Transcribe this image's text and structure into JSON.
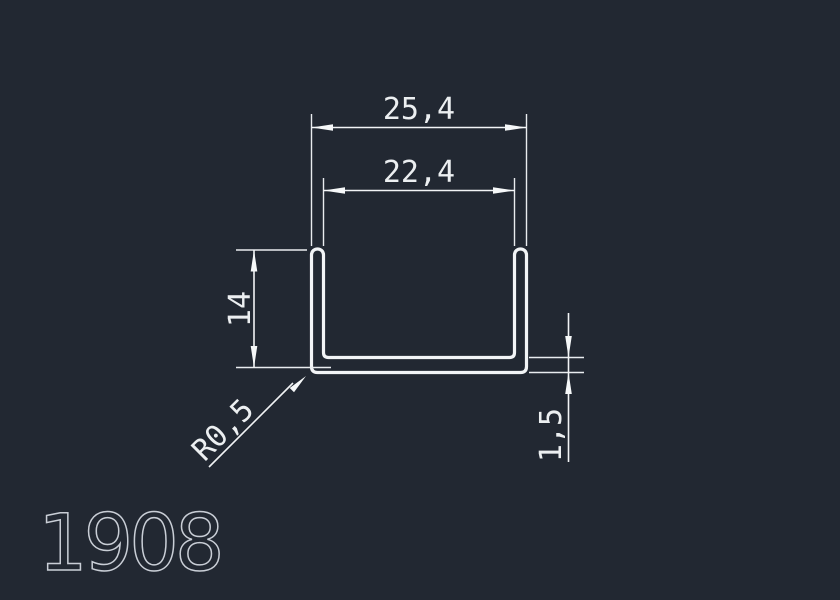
{
  "drawing": {
    "part_number": "1908",
    "shape": "u-channel-profile-cross-section",
    "dimensions": {
      "outer_width": "25,4",
      "inner_width": "22,4",
      "height": "14",
      "wall_thickness": "1,5",
      "corner_radius": "R0,5"
    },
    "colors": {
      "background": "#222832",
      "line": "#f2f4f6",
      "dim_text": "#eceff1",
      "part_number": "#c9ced6"
    }
  }
}
